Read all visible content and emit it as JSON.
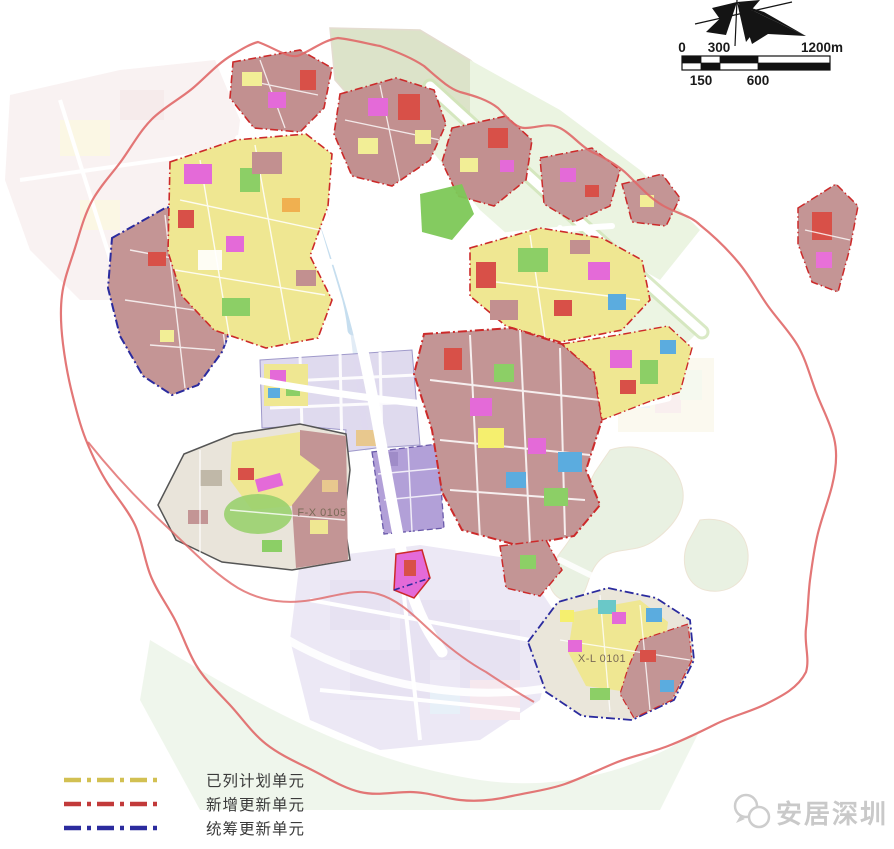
{
  "map": {
    "unit_labels": [
      {
        "text": "F-X 0105"
      },
      {
        "text": "X-L 0101"
      }
    ],
    "boundary_color": "#e06868"
  },
  "legend": {
    "items": [
      {
        "label": "已列计划单元",
        "color": "#d2c052"
      },
      {
        "label": "新增更新单元",
        "color": "#c23a3a"
      },
      {
        "label": "统筹更新单元",
        "color": "#2b2b9e"
      }
    ]
  },
  "scale_bar": {
    "labels_top": [
      "0",
      "300",
      "1200m"
    ],
    "labels_bottom": [
      "150",
      "600"
    ]
  },
  "watermark": {
    "text": "安居深圳"
  }
}
